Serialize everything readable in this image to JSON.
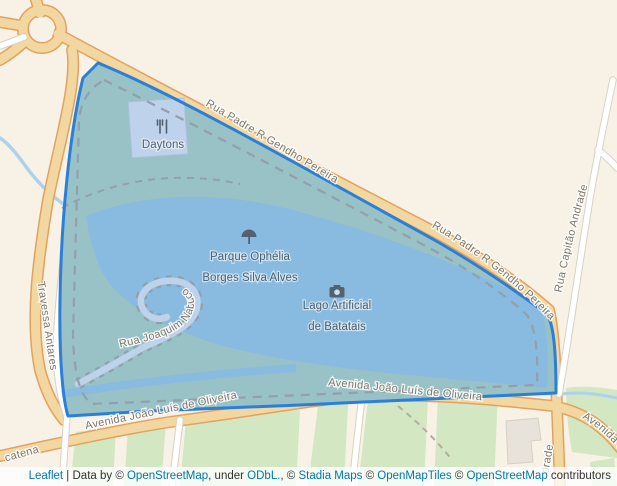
{
  "map": {
    "streets": [
      {
        "label": "Rua Padre R Gendho Pereira"
      },
      {
        "label": "Rua Padre R Gendho Pereira"
      },
      {
        "label": "Rua Capitão Andrade"
      },
      {
        "label": "Travessa Antares"
      },
      {
        "label": "Rua Joaquim Nabuco"
      },
      {
        "label": "Avenida João Luís de Oliveira"
      },
      {
        "label": "Avenida João Luís de Oliveira"
      },
      {
        "label": "Avenida J"
      },
      {
        "label": "catena"
      },
      {
        "label": "drade"
      }
    ],
    "pois": {
      "daytons": {
        "label": "Daytons",
        "icon": "restaurant-icon"
      },
      "parque": {
        "line1": "Parque Ophélia",
        "line2": "Borges Silva Alves",
        "icon": "tree-icon"
      },
      "lago": {
        "line1": "Lago Artificial",
        "line2": "de Batatais",
        "icon": "camera-icon"
      }
    },
    "overlay": {
      "stroke_color": "#2b7fd8",
      "fill_color": "rgba(51,136,255,0.06)"
    },
    "colors": {
      "land": "#f7f1e6",
      "road_major_fill": "#f2d7a0",
      "road_major_casing": "#e2a25f",
      "road_minor_fill": "#ffffff",
      "road_minor_casing": "#d8d2c6",
      "park_inside": "#9fc6c3",
      "water": "#8fbedf",
      "green_area": "#d2e7c2",
      "building": "#e7e3db",
      "dashed_path": "#99a1a8",
      "street_label": "#7d7769",
      "poi_label": "#4c6170",
      "link": "#0078a8"
    }
  },
  "attribution": {
    "parts": [
      {
        "text": "Leaflet",
        "link": true
      },
      {
        "text": " | Data by © ",
        "link": false
      },
      {
        "text": "OpenStreetMap",
        "link": true
      },
      {
        "text": ", under ",
        "link": false
      },
      {
        "text": "ODbL.",
        "link": true
      },
      {
        "text": ", © ",
        "link": false
      },
      {
        "text": "Stadia Maps",
        "link": true
      },
      {
        "text": " © ",
        "link": false
      },
      {
        "text": "OpenMapTiles",
        "link": true
      },
      {
        "text": " © ",
        "link": false
      },
      {
        "text": "OpenStreetMap",
        "link": true
      },
      {
        "text": " contributors",
        "link": false
      }
    ]
  }
}
